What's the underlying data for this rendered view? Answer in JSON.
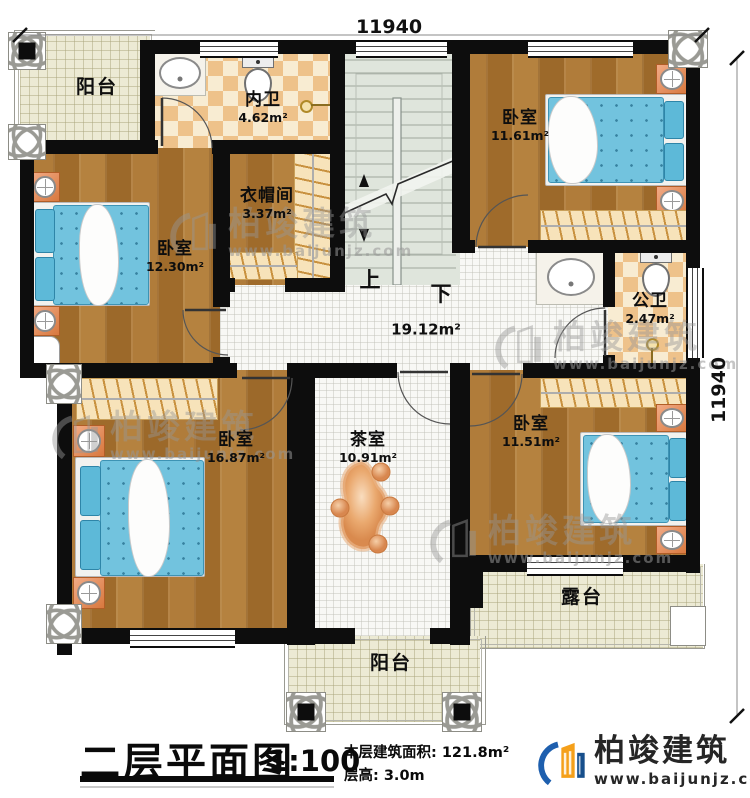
{
  "dimensions": {
    "top": "11940",
    "right": "11940"
  },
  "rooms": {
    "balconyTop": {
      "name": "阳台"
    },
    "innerBath": {
      "name": "内卫",
      "area": "4.62m²"
    },
    "bedroomTR": {
      "name": "卧室",
      "area": "11.61m²"
    },
    "closet": {
      "name": "衣帽间",
      "area": "3.37m²"
    },
    "bedroomLeft": {
      "name": "卧室",
      "area": "12.30m²"
    },
    "hallway": {
      "area": "19.12m²",
      "up": "上",
      "down": "下"
    },
    "publicBath": {
      "name": "公卫",
      "area": "2.47m²"
    },
    "bedroomBL": {
      "name": "卧室",
      "area": "16.87m²"
    },
    "teaRoom": {
      "name": "茶室",
      "area": "10.91m²"
    },
    "bedroomBR": {
      "name": "卧室",
      "area": "11.51m²"
    },
    "terrace": {
      "name": "露台"
    },
    "balconyBottom": {
      "name": "阳台"
    }
  },
  "titleblock": {
    "title": "二层平面图",
    "scale": "1:100",
    "area_text": "本层建筑面积: 121.8m²",
    "floor_height_text": "层高: 3.0m"
  },
  "brand": {
    "name": "柏竣建筑",
    "website": "www.baijunjz.com"
  },
  "watermark": {
    "name": "柏竣建筑",
    "website": "www.baijunjz.com"
  },
  "colors": {
    "wall": "#0d0d0d",
    "wood_floor": "#a8742f",
    "tile_light": "#f8f8f5",
    "tile_checker": "#eec28a",
    "stairs": "#dfe5dc",
    "balcony_tile": "#ecead4",
    "bed_blue": "#72c3de",
    "accent_orange": "#e0915c",
    "brand_blue": "#1e5fae",
    "brand_orange": "#f5a01a"
  }
}
